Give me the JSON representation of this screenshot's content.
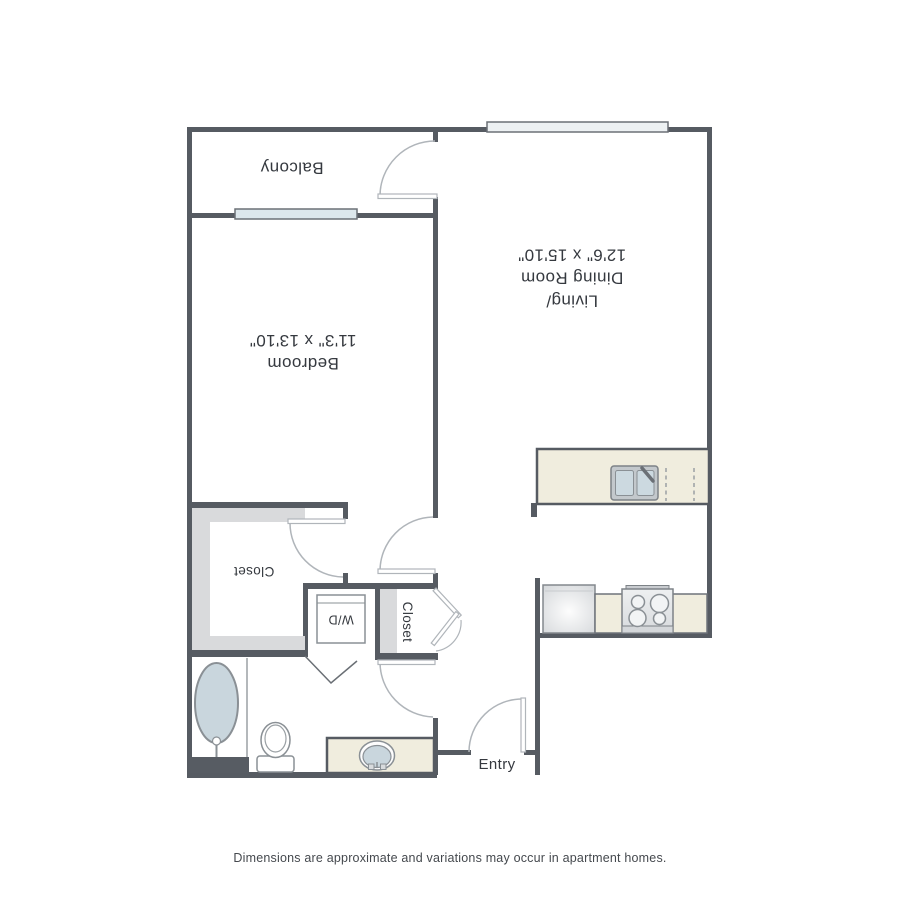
{
  "floorplan": {
    "rooms": {
      "balcony": {
        "label": "Balcony"
      },
      "bedroom": {
        "label": "Bedroom",
        "dimensions": "11'3\" x 13'10\""
      },
      "living_dining": {
        "label_line1": "Living/",
        "label_line2": "Dining Room",
        "dimensions": "12'6\" x 15'10\""
      },
      "walkin_closet": {
        "label": "Closet"
      },
      "laundry": {
        "label": "W/D"
      },
      "hall_closet": {
        "label": "Closet"
      },
      "entry": {
        "label": "Entry"
      }
    },
    "fixtures": [
      "bathtub",
      "toilet",
      "vanity-sink",
      "kitchen-sink",
      "dishwasher",
      "refrigerator",
      "stove",
      "washer-dryer",
      "balcony-window",
      "living-room-window",
      "entry-door",
      "bedroom-door",
      "bathroom-door",
      "closet-doors",
      "walkin-closet-shelves"
    ],
    "colors": {
      "wall": "#565b62",
      "counter": "#f0edde",
      "window_glass": "#dce7ec",
      "water_fixture": "#c9d6dd",
      "closet_shelf": "#d9dadc",
      "door_swing": "#b0b5ba"
    }
  },
  "footer": {
    "disclaimer": "Dimensions are approximate and variations may occur in apartment homes."
  }
}
